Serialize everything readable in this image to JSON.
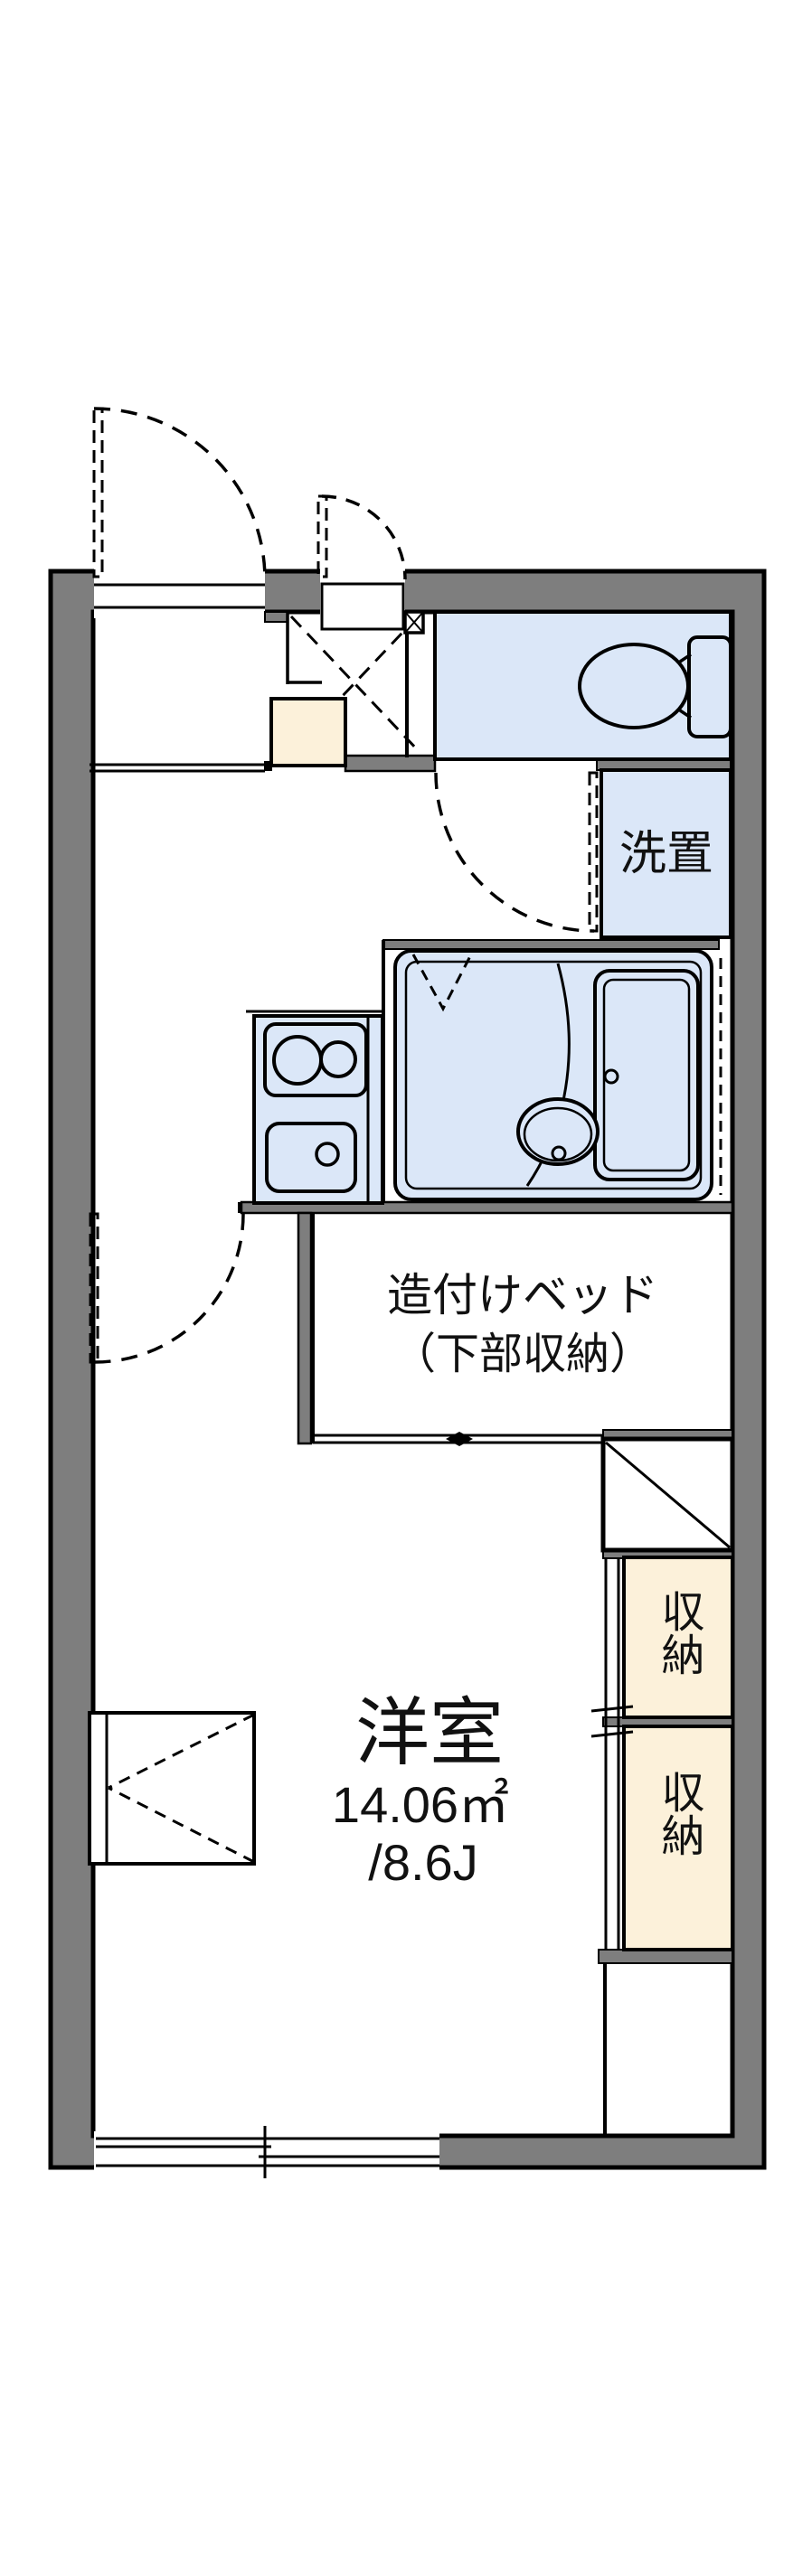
{
  "floor_plan": {
    "labels": {
      "laundry": "洗置",
      "bed_line1": "造付けベッド",
      "bed_line2": "（下部収納）",
      "room_name": "洋室",
      "room_area": "14.06㎡",
      "room_tatami": "/8.6J",
      "storage_top": "収納",
      "storage_bottom": "収納"
    },
    "colors": {
      "wall_gray": "#7e7e7e",
      "wet_area_blue": "#dbe7f8",
      "storage_cream": "#fcf1da",
      "line_black": "#000000",
      "background": "#ffffff"
    }
  }
}
